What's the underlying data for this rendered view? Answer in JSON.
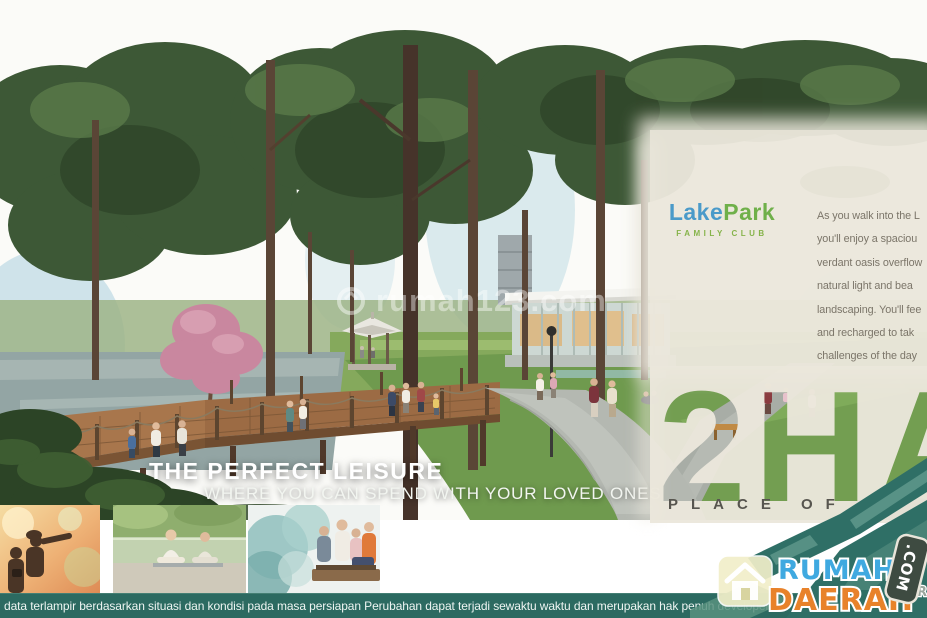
{
  "watermark": {
    "text": "rumah123.com"
  },
  "hero": {
    "title": "THE PERFECT LEISURE",
    "subtitle": "WHERE YOU CAN SPEND WITH YOUR LOVED ONES"
  },
  "panel": {
    "logo_part1": "Lake",
    "logo_part2": "Park",
    "logo_sub": "FAMILY CLUB",
    "paragraph_lines": [
      "As you walk into the L",
      "you'll enjoy a spaciou",
      "verdant oasis overflow",
      "natural light and bea",
      "landscaping. You'll fee",
      "and recharged to tak",
      "challenges of the day"
    ],
    "area_headline": "2HA",
    "tagline": "PLACE OF BE"
  },
  "footer": {
    "disclaimer": "data terlampir berdasarkan situasi dan kondisi pada masa persiapan Perubahan dapat terjadi sewaktu waktu dan merupakan hak penuh developer"
  },
  "agency": {
    "name_line1": "RUMAH",
    "name_line2": "DAERAH",
    "tld": ".COM",
    "partial_text": "AR"
  },
  "colors": {
    "panel_cream": "#ebe7dc",
    "footer_teal": "#2c6a61",
    "ribbon_teal": "#2f6f66",
    "rumah_blue": "#3fa9e0",
    "daerah_orange": "#e8822a",
    "lakepark_blue": "#4a9ac9",
    "lakepark_green": "#6fb04a"
  }
}
